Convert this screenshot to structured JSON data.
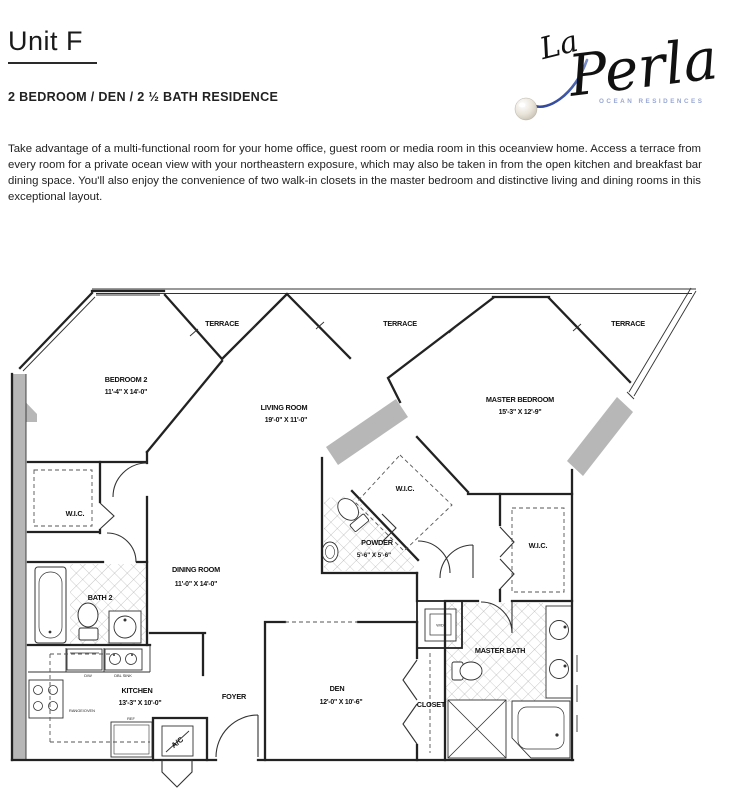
{
  "page": {
    "title": "Unit F",
    "subtitle": "2 BEDROOM / DEN / 2 ½ BATH RESIDENCE",
    "description": "Take advantage of a multi-functional room for your home office, guest room or media room in this oceanview home. Access a terrace from every room for a private ocean view with your northeastern exposure, which may also be taken in from the open kitchen and breakfast bar dining space. You'll also enjoy the convenience of two walk-in closets in the master bedroom and distinctive living and dining rooms in this exceptional layout."
  },
  "logo": {
    "script_small": "La",
    "script_large": "Perla",
    "tagline": "OCEAN RESIDENCES",
    "brand_blue": "#4760ae",
    "brand_blue_light": "#8ea0d2"
  },
  "floorplan": {
    "terraces": [
      "TERRACE",
      "TERRACE",
      "TERRACE"
    ],
    "wic_labels": [
      "W.I.C.",
      "W.I.C.",
      "W.I.C."
    ],
    "rooms": {
      "bedroom2": {
        "name": "BEDROOM 2",
        "dims": "11'-4\" X 14'-0\""
      },
      "living": {
        "name": "LIVING ROOM",
        "dims": "19'-0\" X 11'-0\""
      },
      "master": {
        "name": "MASTER BEDROOM",
        "dims": "15'-3\" X 12'-9\""
      },
      "dining": {
        "name": "DINING ROOM",
        "dims": "11'-0\" X 14'-0\""
      },
      "kitchen": {
        "name": "KITCHEN",
        "dims": "13'-3\" X 10'-0\""
      },
      "den": {
        "name": "DEN",
        "dims": "12'-0\" X 10'-6\""
      },
      "powder": {
        "name": "POWDER",
        "dims": "5'-6\" X 5'-6\""
      },
      "bath2": {
        "name": "BATH 2"
      },
      "masterbath": {
        "name": "MASTER BATH"
      },
      "foyer": {
        "name": "FOYER"
      },
      "closet": {
        "name": "CLOSET"
      },
      "ac": {
        "name": "A/C"
      },
      "wd": {
        "name": "W/D"
      }
    },
    "appliances": {
      "dbl_sink": "DBL SINK",
      "dw": "D/W",
      "range_oven": "RANGE/OVEN",
      "ref": "REF"
    }
  }
}
